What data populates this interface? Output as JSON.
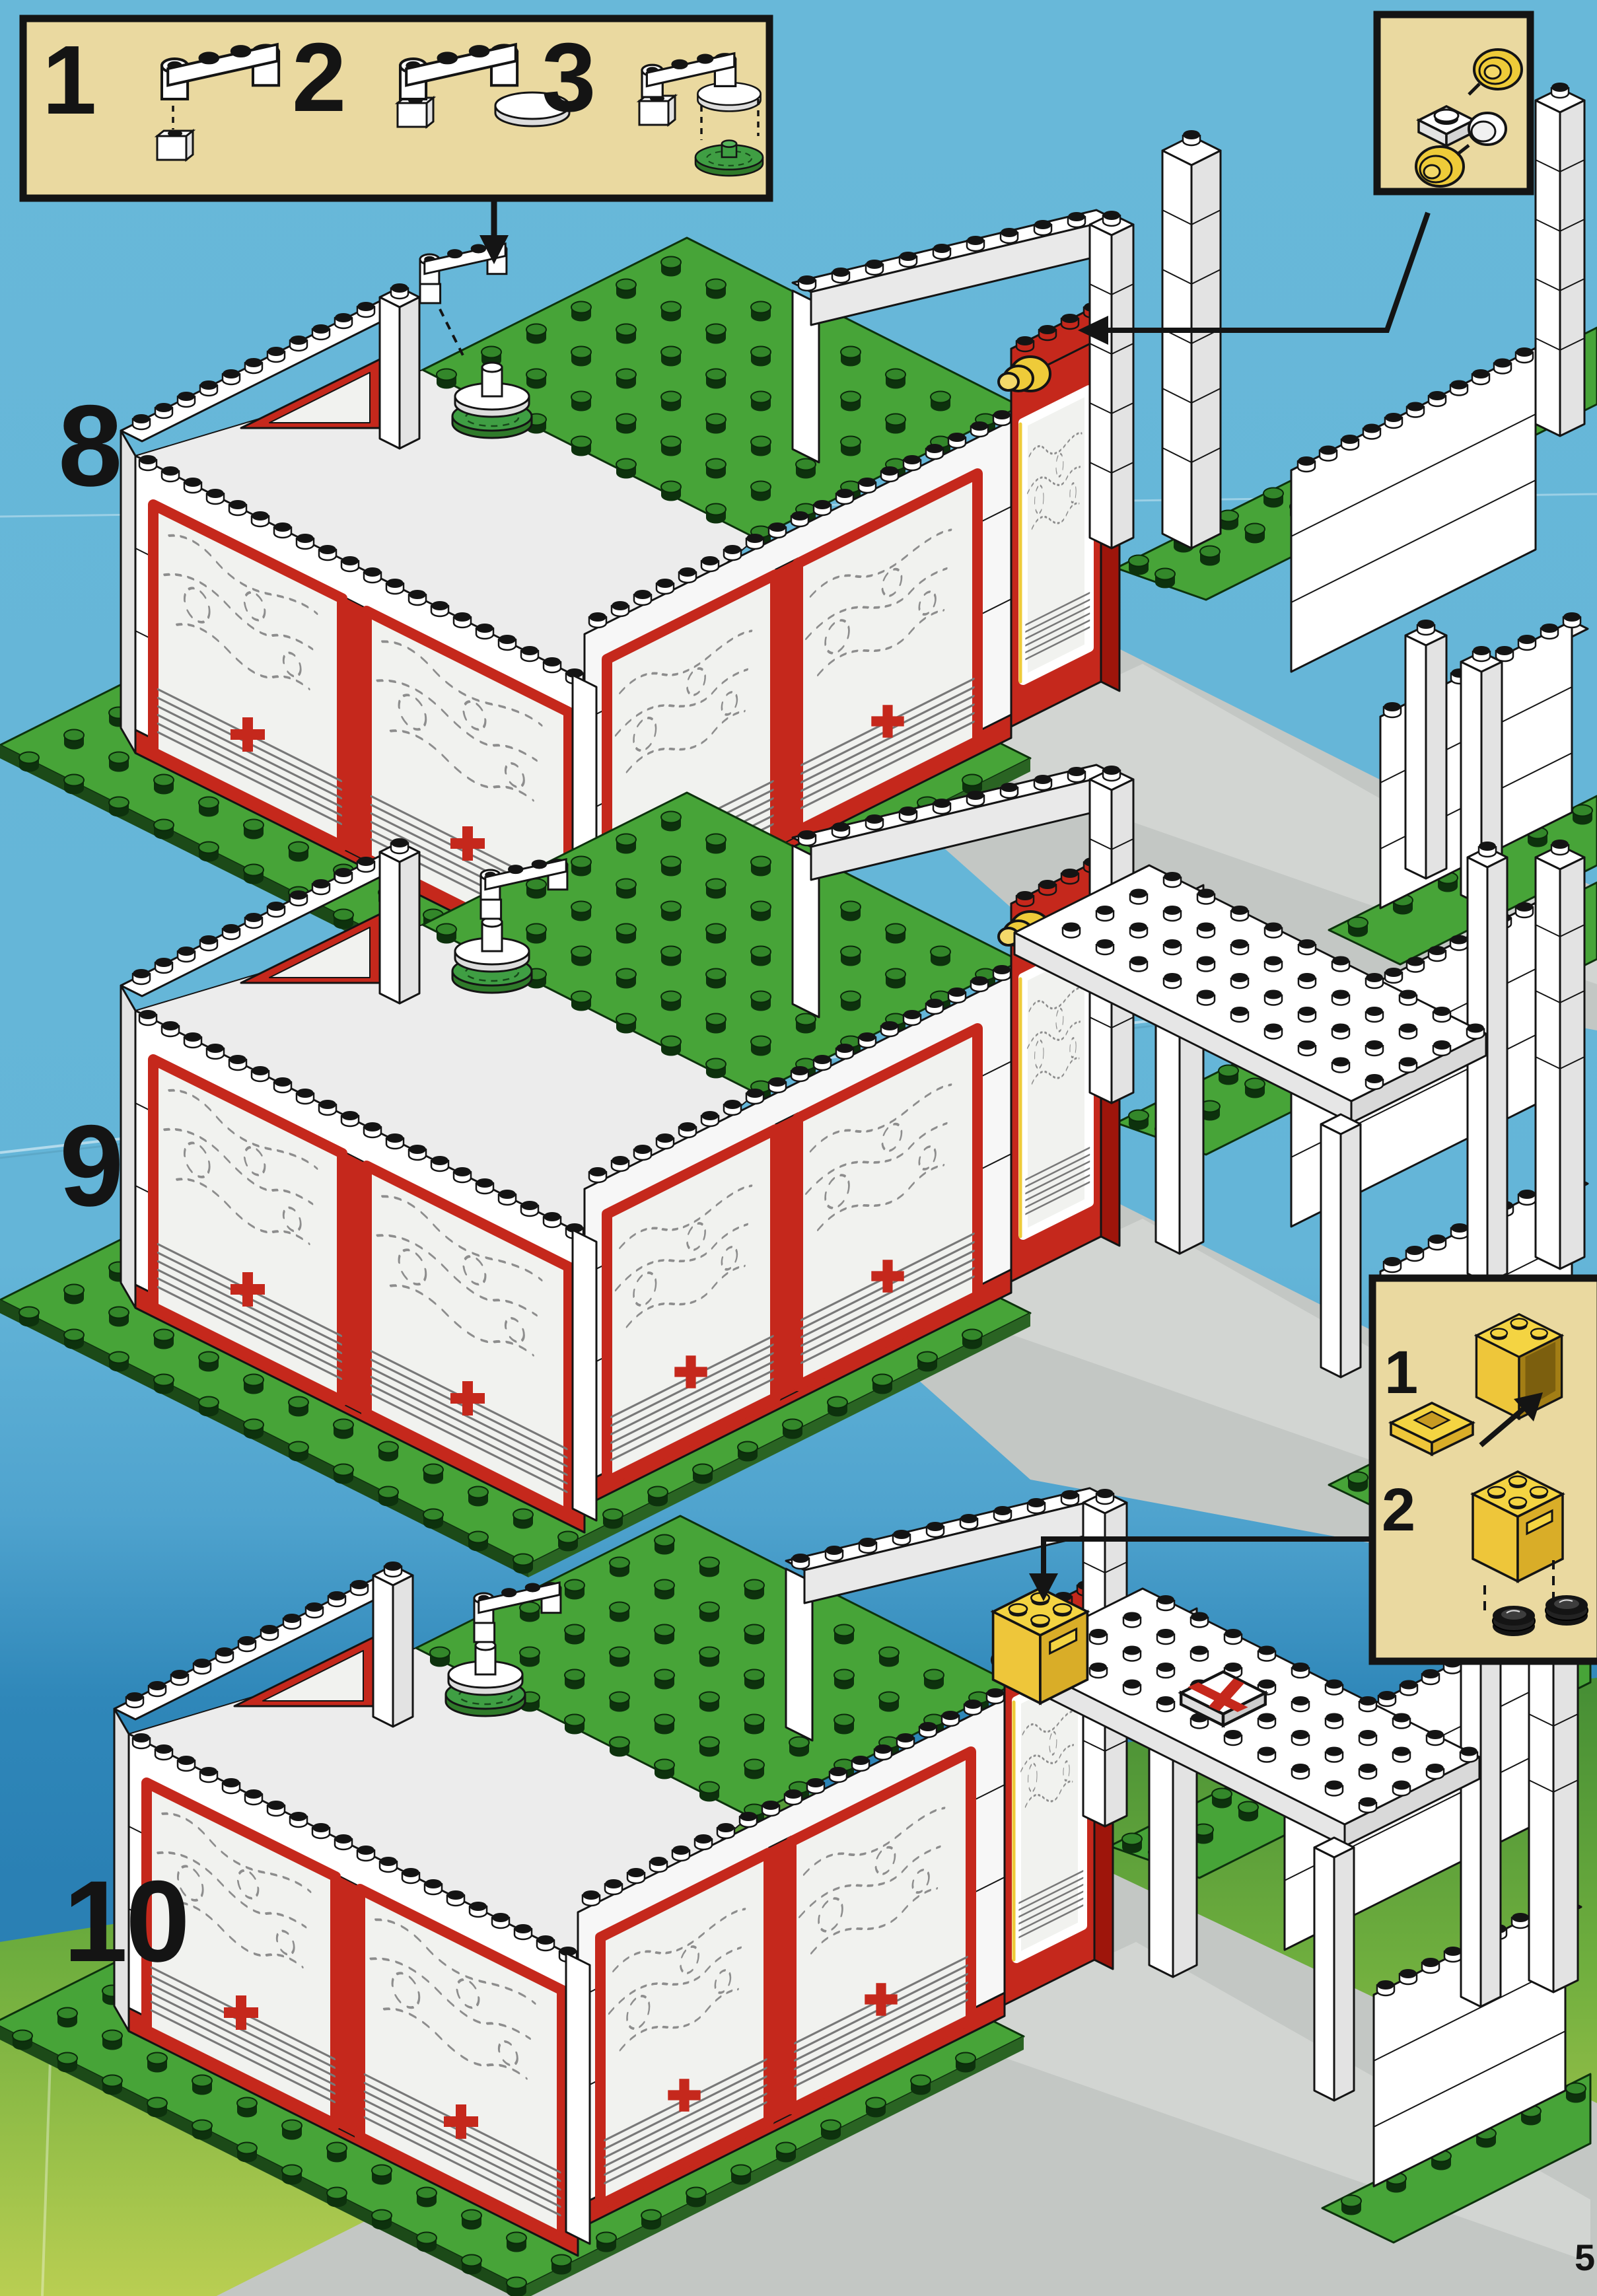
{
  "page": {
    "number": "5"
  },
  "steps": [
    {
      "label": "8",
      "shows": "hospital walls with sliding doors, antenna parts lowered onto roof dish, lamp arrow, loose white pillars along driveway"
    },
    {
      "label": "9",
      "shows": "antenna mounted, white canopy roof placed over the driveway pillars"
    },
    {
      "label": "10",
      "shows": "yellow container placed on red wall, red-cross tile on canopy roof"
    }
  ],
  "callouts": {
    "antenna": {
      "substeps": [
        "1",
        "2",
        "3"
      ]
    },
    "lamp": {
      "substeps": []
    },
    "container": {
      "substeps": [
        "1",
        "2"
      ]
    }
  },
  "icons": [
    "down-arrow-icon",
    "left-arrow-icon",
    "up-right-arrow-icon",
    "dashed-guide-line"
  ],
  "colors": {
    "sky": "#66b6d8",
    "sky_deep": "#2c83b6",
    "grass": "#4f9f3d",
    "grass_light": "#b9ce52",
    "baseplate_green": "#47a438",
    "stud_green": "#33872a",
    "road_gray": "#c3c7c4",
    "brick_white": "#ffffff",
    "brick_shade": "#e3e3e3",
    "brick_red": "#c5281c",
    "red_dark": "#9e150b",
    "trans_yellow": "#eecb39",
    "glass": "#f1f2ef",
    "callout_bg": "#ead9a0",
    "outline": "#141414"
  }
}
